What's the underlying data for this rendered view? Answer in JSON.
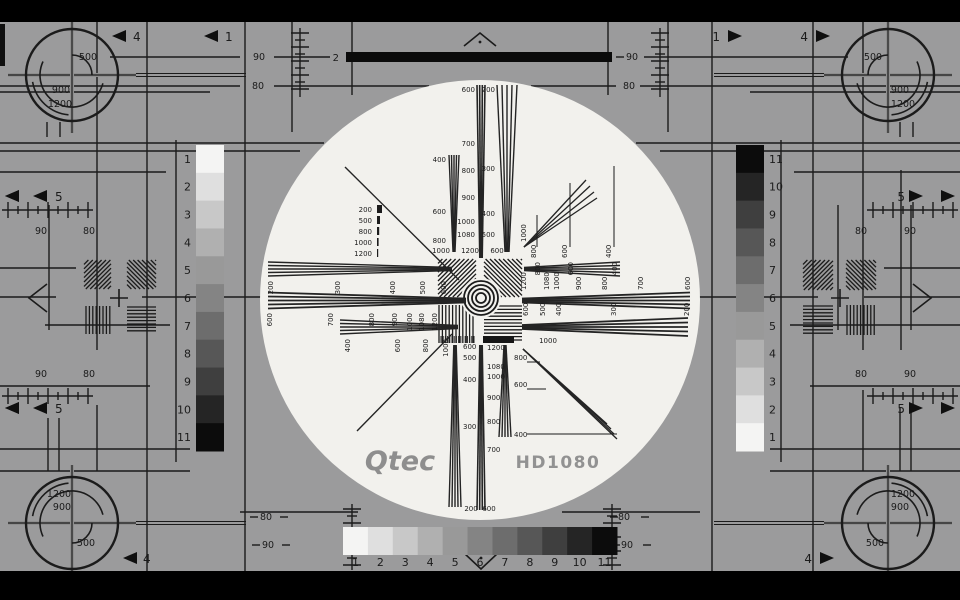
{
  "screen": {
    "width": 960,
    "height": 600
  },
  "colors": {
    "letterbox": "#000000",
    "background": "#9b9b9c",
    "ink": "#1b1b1b",
    "circle": "#f2f1ed",
    "logo": "#8e8e8e",
    "model": "#929292",
    "crosshair_gray": "#8f8f8f",
    "grayscale": [
      "#f4f4f3",
      "#dfdfdf",
      "#c8c8c8",
      "#b0b0b0",
      "#999999",
      "#848484",
      "#6d6d6d",
      "#575757",
      "#3f3f3f",
      "#252525",
      "#0c0c0c"
    ]
  },
  "branding": {
    "logo": "Qtec",
    "model": "HD1080"
  },
  "top_bar": {
    "label": "2"
  },
  "scan_labels": {
    "ninety": "90",
    "eighty": "80"
  },
  "arrow_labels": {
    "one": "1",
    "four": "4",
    "five": "5"
  },
  "corner_labels": {
    "inner": "500",
    "mid": "900",
    "outer": "1200"
  },
  "grayscale": {
    "steps": [
      "1",
      "2",
      "3",
      "4",
      "5",
      "6",
      "7",
      "8",
      "9",
      "10",
      "11"
    ]
  },
  "resolution_wedges": {
    "h_left_top": [
      "200",
      "300",
      "400",
      "500",
      "600"
    ],
    "h_left_mid": [
      "600",
      "700",
      "800",
      "900",
      "1000",
      "1080",
      "1200"
    ],
    "h_left_bottom": [
      "400",
      "600",
      "800",
      "1000"
    ],
    "h_right_top": [
      "800",
      "600",
      "400"
    ],
    "h_right_mid": [
      "1200",
      "1080",
      "1000",
      "900",
      "800",
      "700",
      "600"
    ],
    "h_right_bottom": [
      "600",
      "500",
      "400",
      "300",
      "200"
    ],
    "v_top_left": [
      "400",
      "600",
      "800"
    ],
    "v_top_mid": [
      "600",
      "700",
      "800",
      "900",
      "1000",
      "1080"
    ],
    "v_top_right": [
      "200",
      "300",
      "400",
      "500"
    ],
    "v_bottom_left": [
      "600",
      "500",
      "400",
      "300"
    ],
    "v_bottom_mid": [
      "1200",
      "1080",
      "1000",
      "900",
      "800",
      "700"
    ],
    "v_bottom_right": [
      "800",
      "600",
      "400"
    ],
    "diag_upper_right": {
      "apex": "1000",
      "ticks": [
        "800",
        "600",
        "400"
      ]
    },
    "diag_lower_right": {
      "apex": "1000"
    },
    "legend": [
      "200",
      "500",
      "800",
      "1000",
      "1200"
    ],
    "center_row_above": [
      "1000",
      "1200",
      "600"
    ],
    "circle_bottom": [
      "200",
      "600"
    ]
  }
}
